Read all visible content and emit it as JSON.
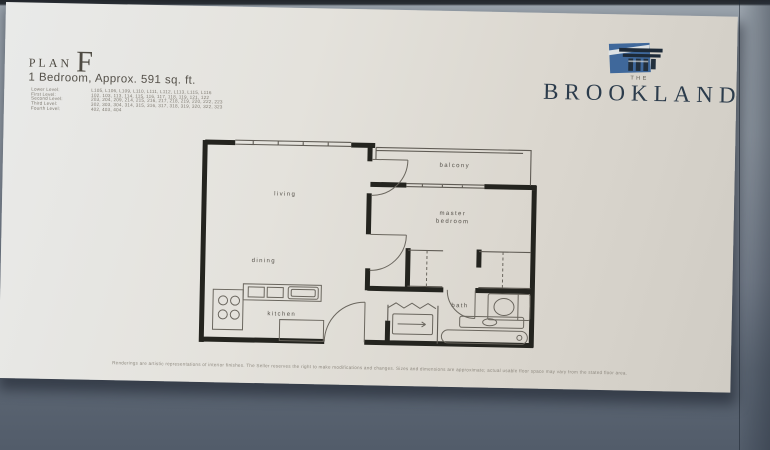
{
  "poster": {
    "plan_label": "PLAN",
    "plan_letter": "F",
    "subtitle": "1 Bedroom, Approx. 591 sq. ft.",
    "levels": [
      {
        "label": "Lower Level:",
        "units": "L105, L106, L109, L110, L111, L112, L113, L115, L116"
      },
      {
        "label": "First Level:",
        "units": "102, 103, 113, 114, 115, 116, 117, 118, 119, 121, 122"
      },
      {
        "label": "Second Level:",
        "units": "203, 204, 209, 214, 215, 216, 217, 218, 219, 220, 222, 223"
      },
      {
        "label": "Third Level:",
        "units": "302, 303, 304, 314, 315, 316, 317, 318, 319, 320, 322, 323"
      },
      {
        "label": "Fourth Level:",
        "units": "402, 403, 404"
      }
    ],
    "brand": {
      "the": "THE",
      "name": "BROOKLAND",
      "logo_color": "#3f689b",
      "name_color": "#2c3c4c"
    },
    "rooms": {
      "living": "living",
      "dining": "dining",
      "kitchen": "kitchen",
      "master_1": "master",
      "master_2": "bedroom",
      "bath": "bath",
      "balcony": "balcony"
    },
    "disclaimer": "Renderings are artistic representations of interior finishes. The Seller reserves the right to make modifications and changes. Sizes and dimensions are approximate; actual usable floor space may vary from the stated floor area."
  }
}
